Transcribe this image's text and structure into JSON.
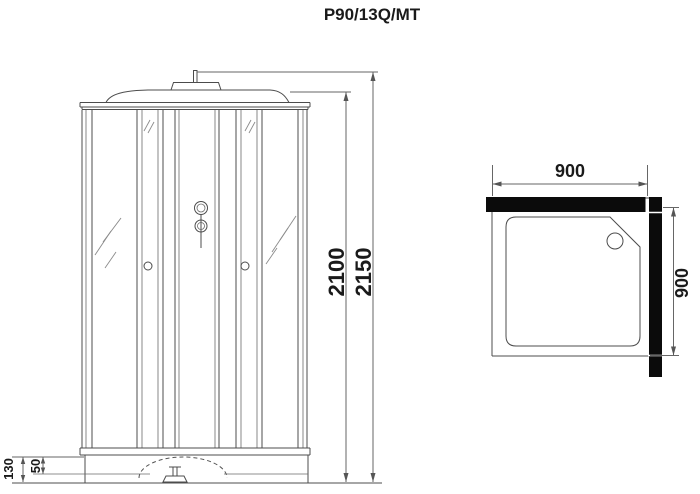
{
  "title": "P90/13Q/MT",
  "views": {
    "front": {
      "name": "Front elevation of shower cabin",
      "dimensions": {
        "total_height_mm": "2150",
        "cabin_height_mm": "2100",
        "base_height_mm": "130",
        "tray_depth_mm": "50"
      }
    },
    "plan": {
      "name": "Plan view of shower tray",
      "dimensions": {
        "width_mm": "900",
        "depth_mm": "900"
      }
    }
  },
  "colors": {
    "background": "#ffffff",
    "outline": "#4c4c4c",
    "dimension_line": "#666666",
    "wall_fill": "#0b0b0b",
    "text": "#1a1a1a"
  }
}
